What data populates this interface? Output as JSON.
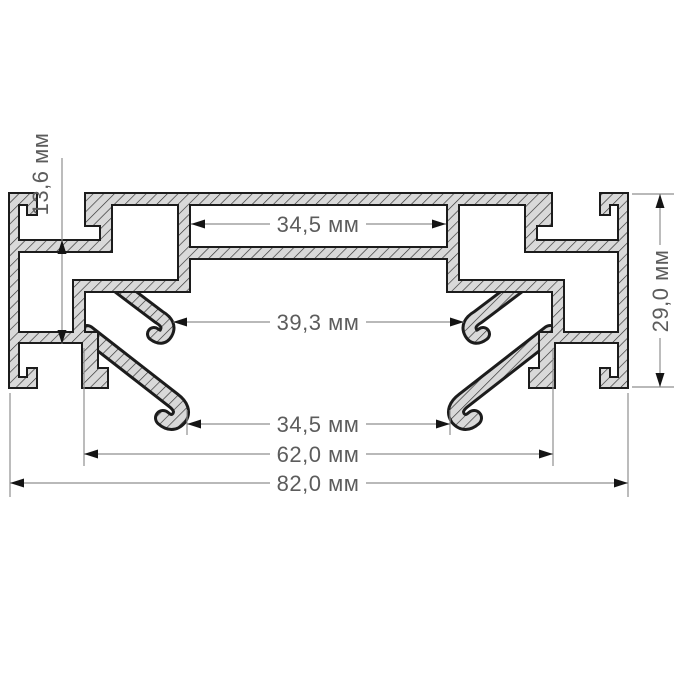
{
  "drawing": {
    "type": "aluminum-profile-cross-section",
    "units": "мм",
    "dimensions": {
      "top_inner_width": {
        "label": "34,5 мм"
      },
      "upper_hook_span": {
        "label": "39,3 мм"
      },
      "lower_hook_span": {
        "label": "34,5 мм"
      },
      "bottom_inner_width": {
        "label": "62,0 мм"
      },
      "overall_width": {
        "label": "82,0 мм"
      },
      "pocket_height": {
        "label": "13,6 мм"
      },
      "overall_height": {
        "label": "29,0 мм"
      }
    },
    "colors": {
      "fill": "#d9d9d9",
      "hatch": "#2e2e2e",
      "outline": "#1c1c1c",
      "dimline": "#8f8f8f",
      "label": "#5c5c5c",
      "arrow": "#141414",
      "background": "#ffffff"
    }
  }
}
